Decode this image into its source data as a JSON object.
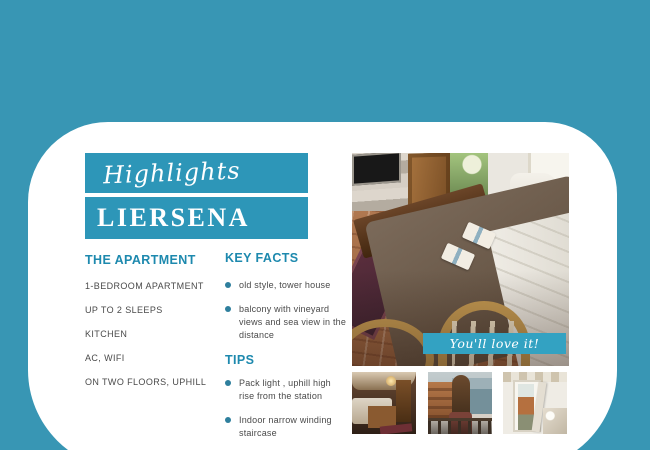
{
  "colors": {
    "background": "#3896B4",
    "card": "#FFFFFF",
    "banner": "#2D96B8",
    "photo_banner": "#33A2C2",
    "heading_text": "#1D89AE",
    "bullet_dot": "#2E7F9D",
    "body_text": "#4A4A4A"
  },
  "header": {
    "eyebrow": "Highlights",
    "title": "LIERSENA"
  },
  "apartment": {
    "heading": "THE APARTMENT",
    "items": [
      "1-BEDROOM APARTMENT",
      "UP TO 2 SLEEPS",
      "KITCHEN",
      "AC, WIFI",
      "ON TWO FLOORS, UPHILL"
    ]
  },
  "key_facts": {
    "heading": "KEY FACTS",
    "items": [
      "old style, tower house",
      "balcony with vineyard views and sea view in the distance"
    ]
  },
  "tips": {
    "heading": "TIPS",
    "items": [
      "Pack light , uphill high rise from the station",
      "Indoor narrow winding staircase"
    ]
  },
  "photos": {
    "caption": "You'll love it!",
    "main_label": "dining room with set table, open door to garden and white chair",
    "thumb_labels": [
      "bedroom with double bed and wooden door",
      "woman with long hair on balcony looking at the sea",
      "open door with village view next to a bed"
    ]
  }
}
